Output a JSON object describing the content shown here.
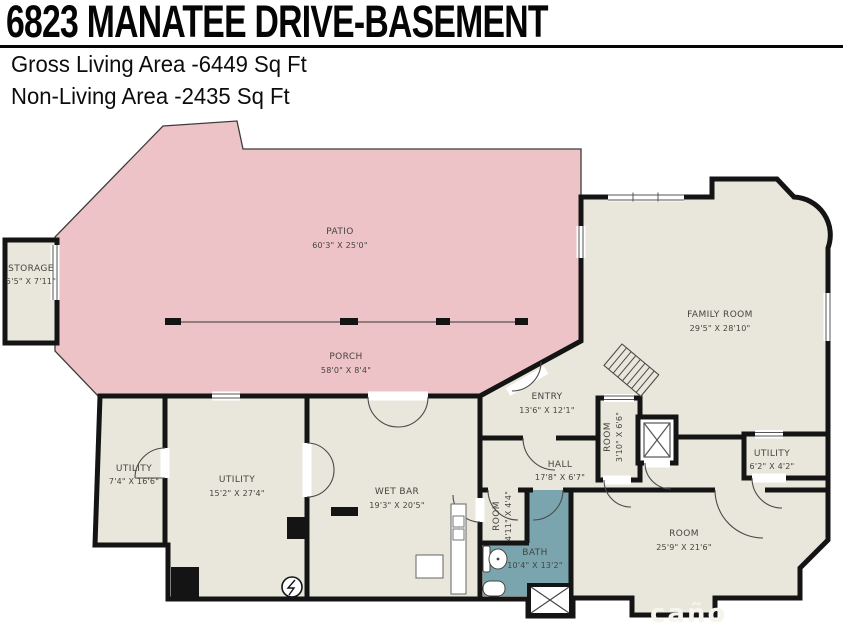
{
  "header": {
    "title": "6823 MANATEE DRIVE-BASEMENT",
    "gross_living": "Gross Living Area -6449 Sq Ft",
    "non_living": "Non-Living Area -2435 Sq Ft"
  },
  "colors": {
    "outdoor_pink": "#eec3c8",
    "floor_beige": "#e9e7dc",
    "bath_teal": "#7aa5ae",
    "wall_black": "#141414",
    "background": "#ffffff"
  },
  "watermark": "caño",
  "rooms": {
    "storage": {
      "name": "STORAGE",
      "dims": "5'5\" X 7'11\""
    },
    "patio": {
      "name": "PATIO",
      "dims": "60'3\" X 25'0\""
    },
    "porch": {
      "name": "PORCH",
      "dims": "58'0\" X 8'4\""
    },
    "family_room": {
      "name": "FAMILY ROOM",
      "dims": "29'5\" X 28'10\""
    },
    "entry": {
      "name": "ENTRY",
      "dims": "13'6\" X 12'1\""
    },
    "room_small": {
      "name": "ROOM",
      "dims": "3'10\" X 6'6\""
    },
    "utility_left": {
      "name": "UTILITY",
      "dims": "7'4\" X 16'6\""
    },
    "utility_mid": {
      "name": "UTILITY",
      "dims": "15'2\" X 27'4\""
    },
    "wet_bar": {
      "name": "WET BAR",
      "dims": "19'3\" X 20'5\""
    },
    "hall": {
      "name": "HALL",
      "dims": "17'8\" X 6'7\""
    },
    "room_tiny": {
      "name": "ROOM",
      "dims": "4'11\" X 4'4\""
    },
    "bath": {
      "name": "BATH",
      "dims": "10'4\" X 13'2\""
    },
    "room_large": {
      "name": "ROOM",
      "dims": "25'9\" X 21'6\""
    },
    "utility_right": {
      "name": "UTILITY",
      "dims": "6'2\" X 4'2\""
    }
  }
}
